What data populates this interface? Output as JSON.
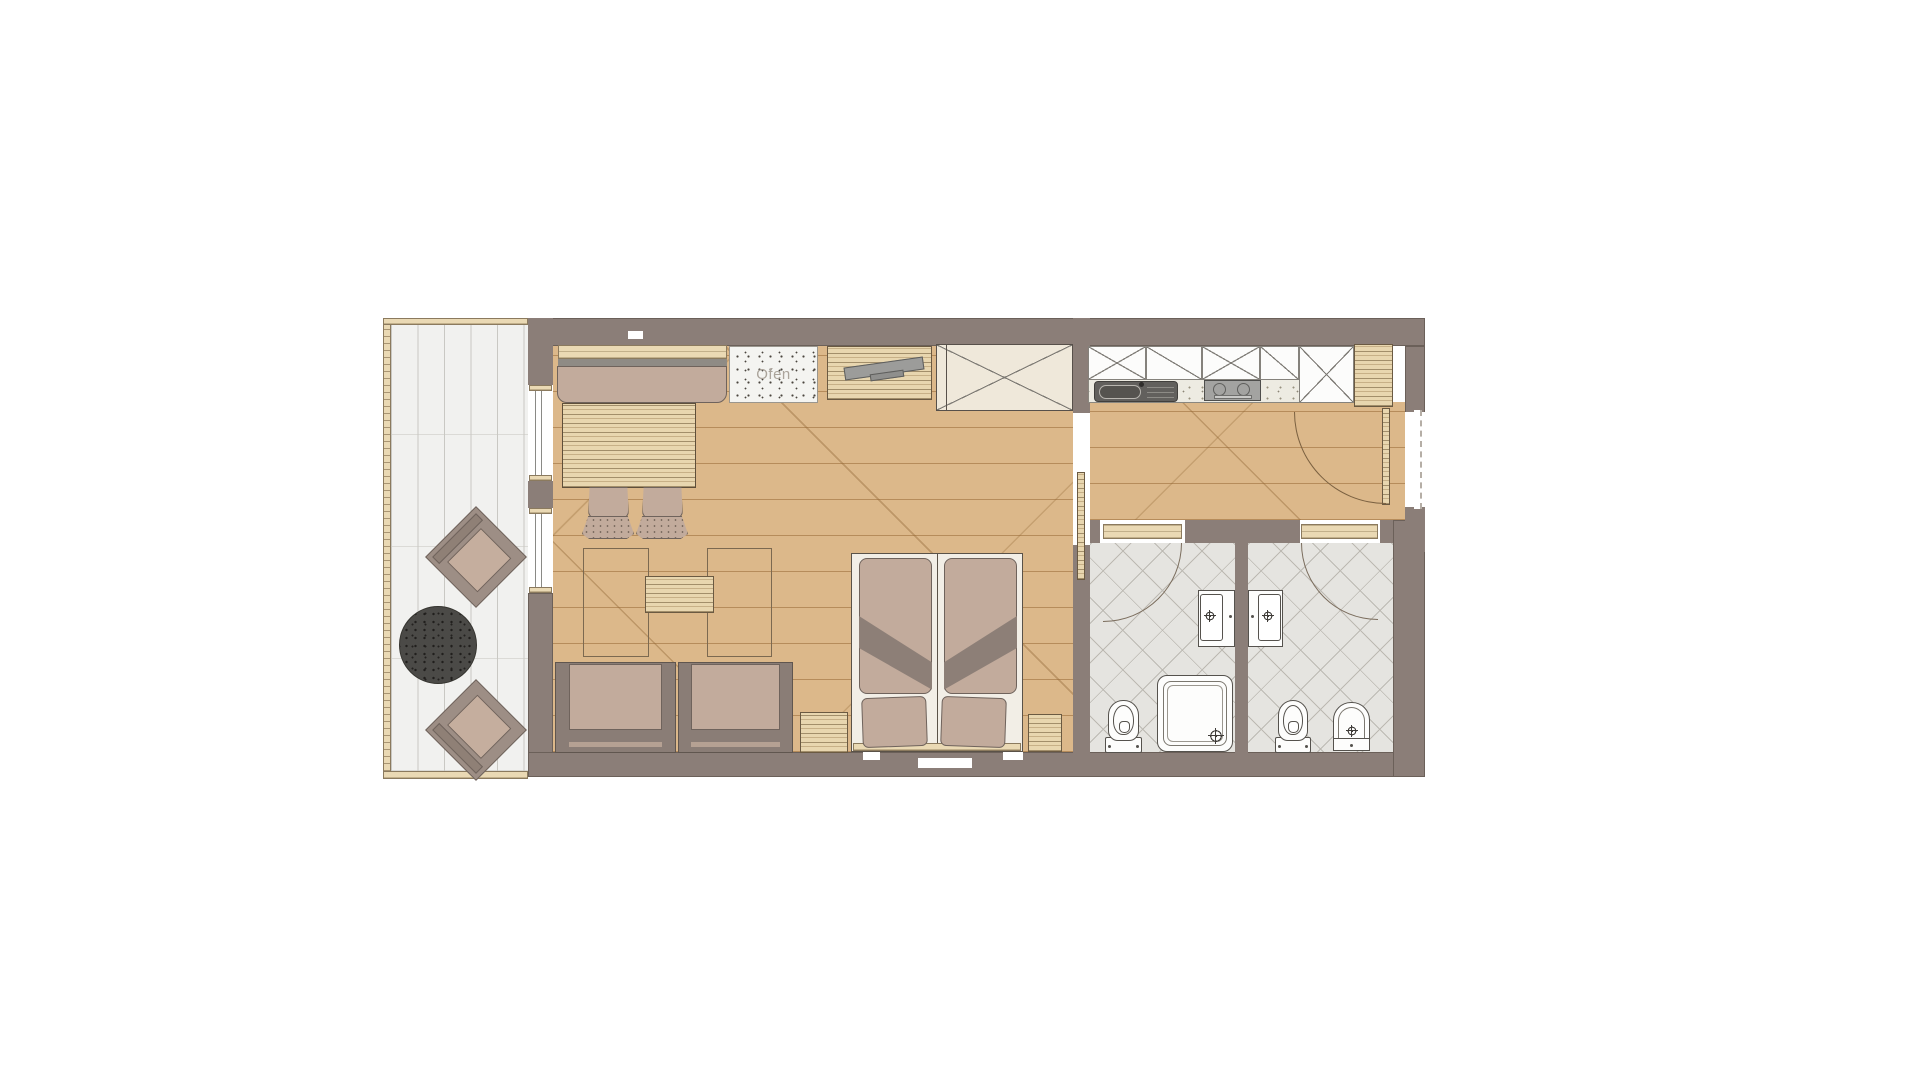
{
  "floorplan": {
    "ofen_label": "Ofen",
    "colors": {
      "wall": "#8b7e78",
      "wood_floor": "#dcb88a",
      "terrace_plank": "#f1f1ef",
      "bath_tile": "#e5e4e0",
      "upholstery": "#c2ab9c",
      "wood_furniture": "#e8d6af",
      "cabinet_white": "#fcfcfb",
      "bed_base": "#f2eee6",
      "wardrobe": "#efe8da",
      "throw": "#8d7f77",
      "rug": "#4b4a47",
      "sink": "#62605d",
      "cooktop": "#a3a3a1"
    }
  }
}
